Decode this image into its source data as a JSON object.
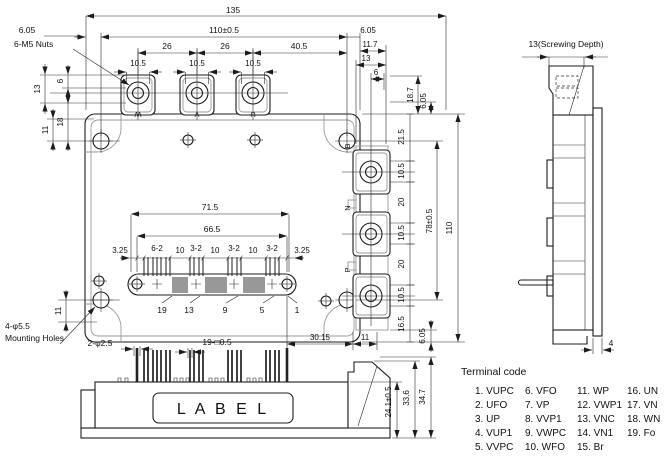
{
  "colors": {
    "line": "#1c1c1c",
    "gray": "#9a9a9a",
    "bg": "#ffffff"
  },
  "top_view": {
    "dim_135": "135",
    "dim_110h": "110±0.5",
    "dim_605_tl": "6.05",
    "note_nuts": "6-M5 Nuts",
    "dim_26a": "26",
    "dim_26b": "26",
    "dim_405": "40.5",
    "dim_105w": "10.5",
    "tr_605": "6.05",
    "tr_117": "11.7",
    "tr_13": "13",
    "tr_6": "6",
    "lc_13": "13",
    "lc_6": "6",
    "lc_18": "18",
    "lc_11t": "11",
    "lc_11b": "11",
    "rc_187": "18.7",
    "rc_605": "6.05",
    "rc_215": "21.5",
    "rc_105": "10.5",
    "rc_20": "20",
    "rc_165": "16.5",
    "rc_78": "78±0.5",
    "rc_110": "110",
    "pin_715": "71.5",
    "pin_665": "66.5",
    "pin_row": [
      "3.25",
      "6-2",
      "10",
      "3-2",
      "10",
      "3-2",
      "10",
      "3-2",
      "3.25"
    ],
    "pin_numbers": [
      "19",
      "13",
      "9",
      "5",
      "1"
    ],
    "terminals_top": [
      "W",
      "V",
      "U"
    ],
    "terminals_right": [
      "B",
      "N",
      "P"
    ],
    "bot_3015": "30.15",
    "bot_11": "11",
    "bot_605": "6.05",
    "note_mount1": "4-φ5.5",
    "note_mount2": "Mounting Holes"
  },
  "front_view": {
    "dim_guide": "2-φ2.5",
    "dim_pins": "19-□0.5",
    "label": "L A B E L",
    "dim_241": "24.1±0.5",
    "dim_336": "33.6",
    "dim_347": "34.7"
  },
  "side_view": {
    "dim_screw": "13(Screwing Depth)",
    "dim_4": "4"
  },
  "terminal_code": {
    "title": "Terminal code",
    "columns": [
      [
        "1. VUPC",
        "2. UFO",
        "3. UP",
        "4. VUP1",
        "5. VVPC"
      ],
      [
        "6. VFO",
        "7. VP",
        "8. VVP1",
        "9. VWPC",
        "10. WFO"
      ],
      [
        "11. WP",
        "12. VWP1",
        "13. VNC",
        "14. VN1",
        "15. Br"
      ],
      [
        "16. UN",
        "17. VN",
        "18. WN",
        "19. Fo"
      ]
    ]
  }
}
